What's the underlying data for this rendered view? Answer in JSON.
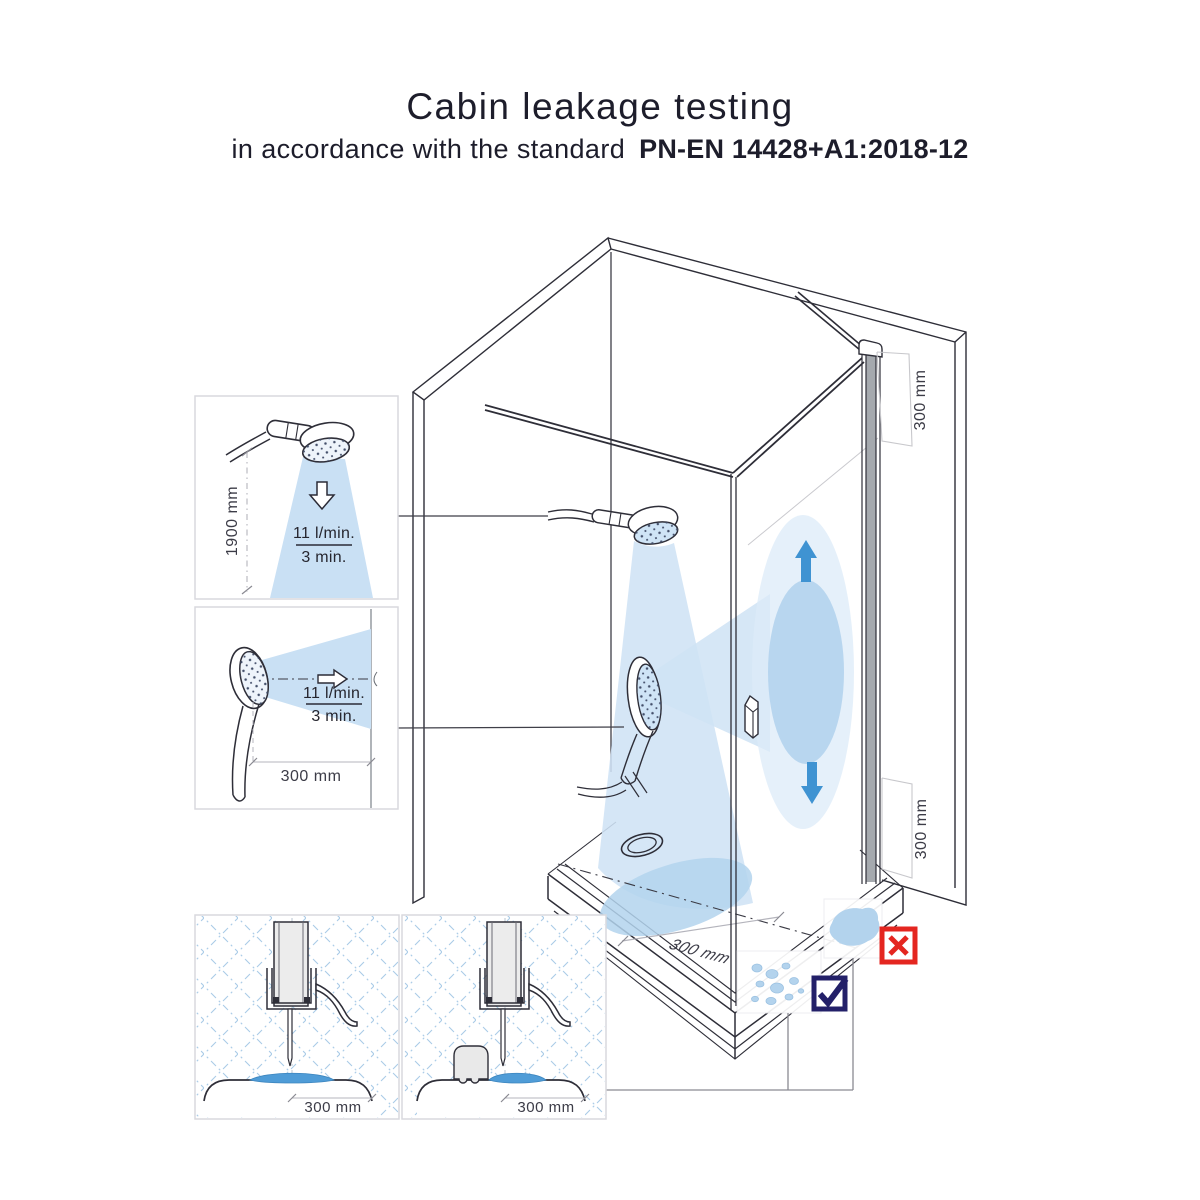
{
  "header": {
    "title": "Cabin leakage testing",
    "subtitle_prefix": "in accordance with the standard",
    "standard_code": "PN-EN 14428+A1:2018-12"
  },
  "insets": {
    "vertical_spray": {
      "height_dimension": "1900 mm",
      "flow_rate": "11 l/min.",
      "duration": "3 min."
    },
    "horizontal_spray": {
      "distance_dimension": "300 mm",
      "flow_rate": "11 l/min.",
      "duration": "3 min."
    },
    "seal_detail_plain": {
      "distance_dimension": "300 mm"
    },
    "seal_detail_threshold": {
      "distance_dimension": "300 mm"
    }
  },
  "cabin": {
    "door_top_dimension": "300 mm",
    "door_bottom_dimension": "300 mm",
    "tray_dimension": "300 mm"
  },
  "icons": {
    "fail": "x-mark",
    "pass": "check-mark",
    "spray_down": "down-arrow",
    "spray_right": "right-arrow",
    "door_spray_up": "up-arrow",
    "door_spray_down": "down-arrow"
  },
  "colors": {
    "spray_light": "#cfe3f5",
    "spray_medium": "#b3d3ed",
    "water": "#4f9cd7",
    "arrow_blue": "#3f93d2",
    "fail_red": "#e42620",
    "pass_navy": "#232069"
  }
}
